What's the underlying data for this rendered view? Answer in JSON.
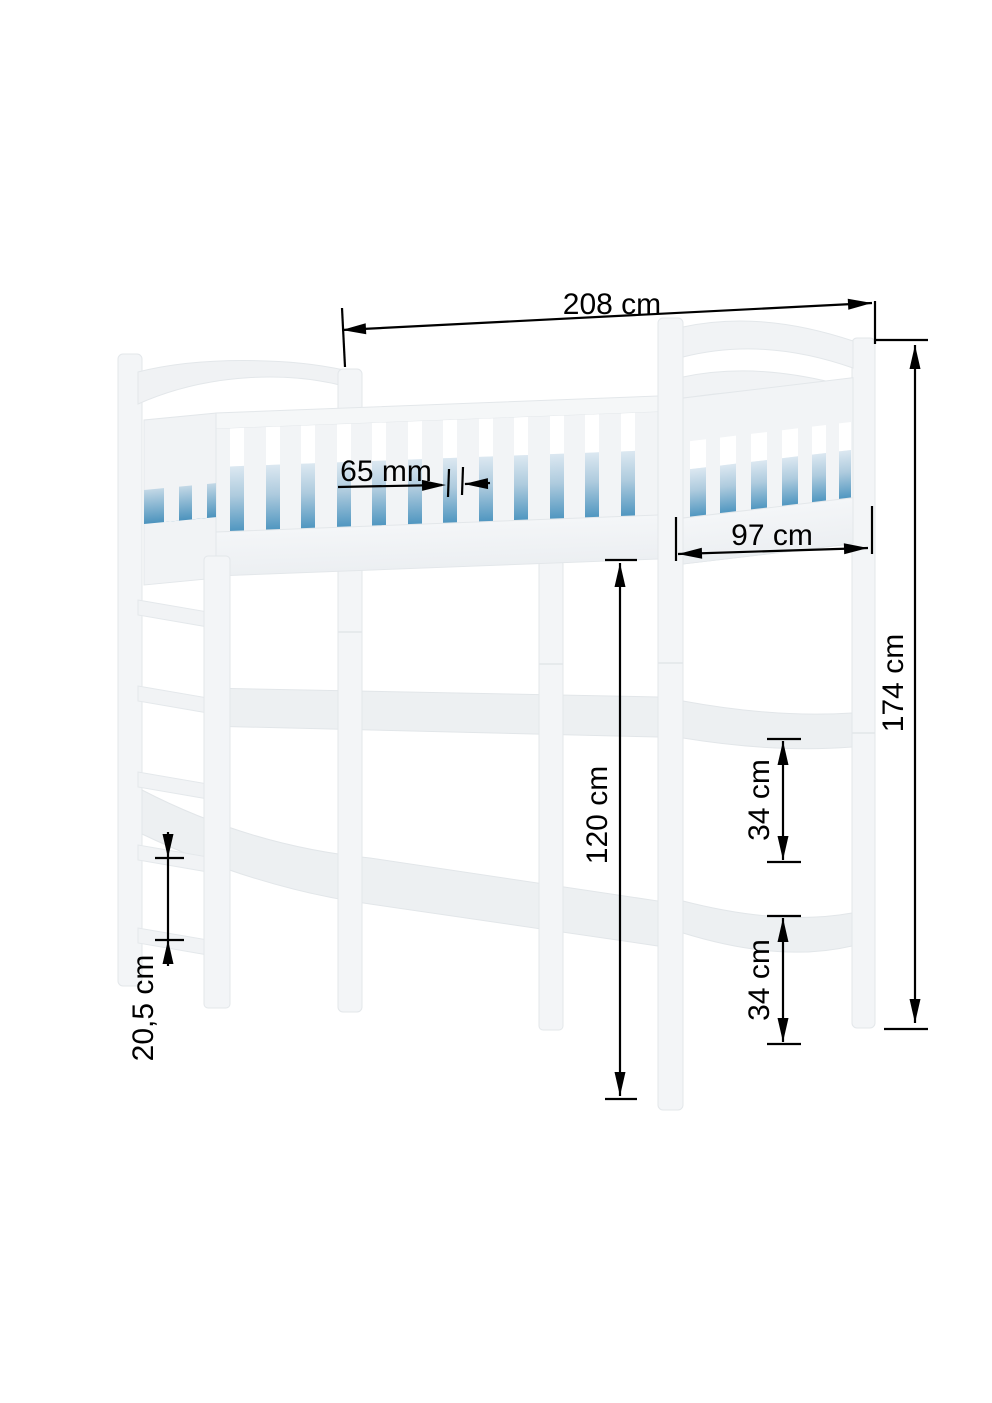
{
  "diagram": {
    "type": "furniture_dimension_drawing",
    "subject": "loft bed with ladder, guard rail and mattress",
    "colors": {
      "background": "#ffffff",
      "furniture_white": "#f2f4f6",
      "furniture_edge": "#e3e7ea",
      "mattress_blue_deep": "#4f96c0",
      "mattress_blue_light": "#d9e6ef",
      "dimension_ink": "#000000"
    },
    "dimensions": {
      "total_length": "208 cm",
      "rail_slat_gap": "65 mm",
      "bed_width": "97 cm",
      "total_height": "174 cm",
      "clearance_height": "120 cm",
      "upper_rail_spacing": "34 cm",
      "lower_rail_spacing": "34 cm",
      "ladder_rung_spacing": "20,5 cm"
    }
  }
}
